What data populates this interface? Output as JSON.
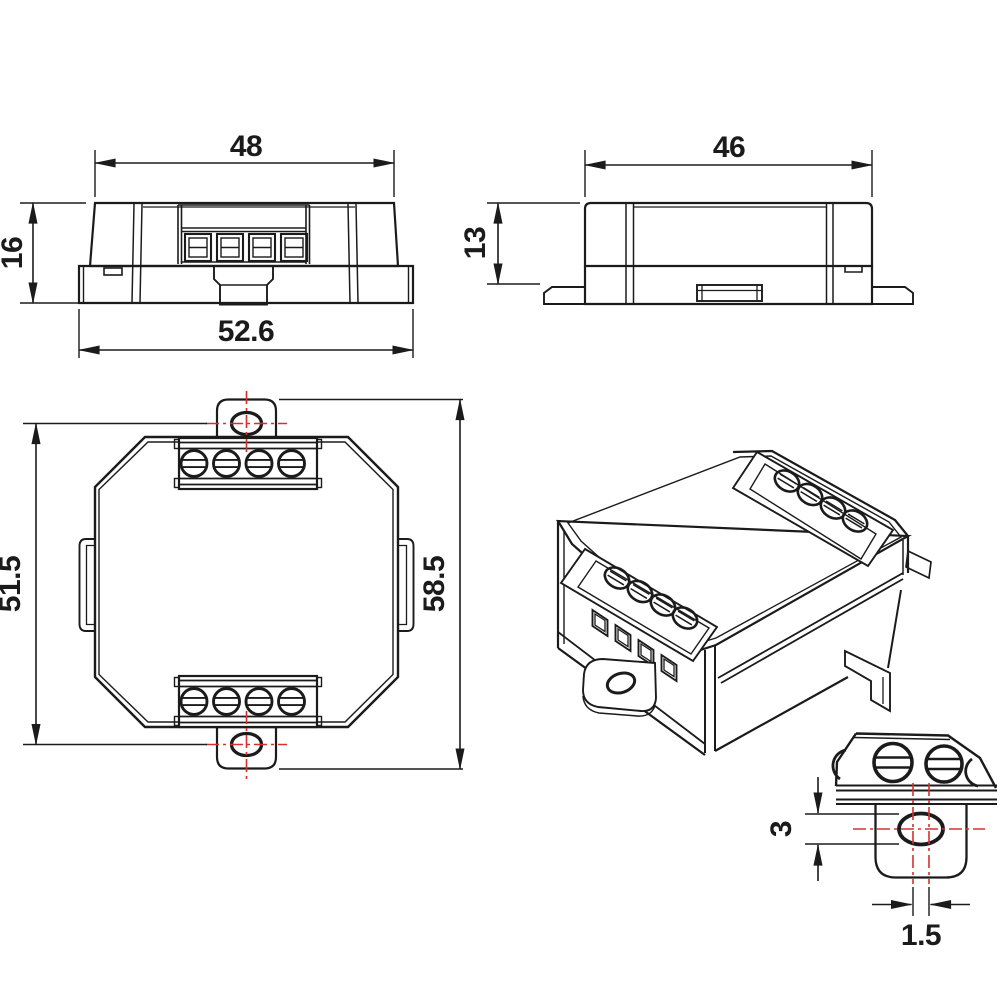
{
  "drawing": {
    "background": "#ffffff",
    "line_color": "#1b1b1b",
    "centerline_color": "#d53030"
  },
  "views": {
    "front": {
      "width_top": "48",
      "height": "16",
      "width_overall": "52.6"
    },
    "side": {
      "width": "46",
      "height": "13"
    },
    "top": {
      "mount_hole_spacing": "51.5",
      "overall_length": "58.5"
    },
    "detail": {
      "hole_height": "3",
      "hole_offset": "1.5"
    }
  }
}
